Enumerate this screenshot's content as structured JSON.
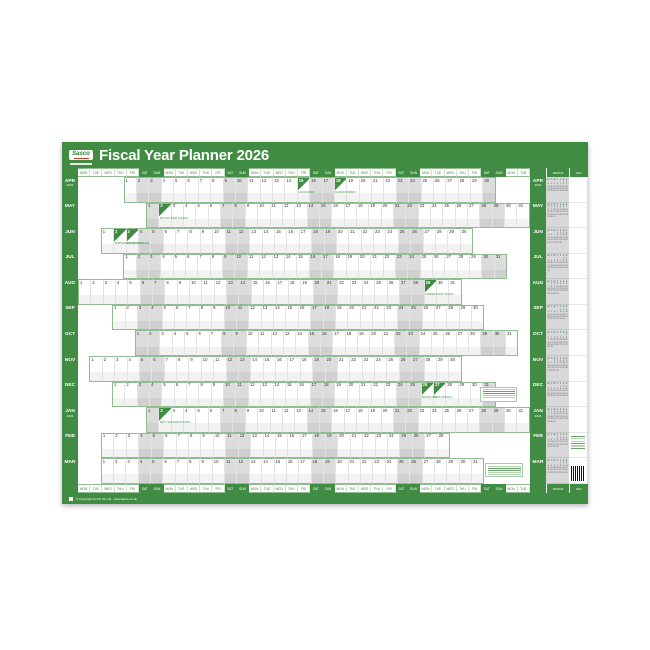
{
  "planner": {
    "brand": "Sasco",
    "title": "Fiscal Year Planner 2026",
    "side_header_year": "2023/24",
    "side_header_key": "KEY",
    "footer_text": "© Copyright ACCO UK Ltd · www.sasco.co.uk",
    "colors": {
      "green": "#3f8c42",
      "weekend_grey": "#dcdcdc",
      "logo_red": "#d23b2f"
    },
    "columns": 37,
    "day_names": [
      "MON",
      "TUE",
      "WED",
      "THU",
      "FRI",
      "SAT",
      "SUN"
    ],
    "months": [
      {
        "label": "APR",
        "year": "2022",
        "start_col": 5,
        "days": 30,
        "holidays": [
          {
            "day": 15,
            "name": "GOOD FRIDAY"
          },
          {
            "day": 18,
            "name": "EASTER MONDAY"
          }
        ]
      },
      {
        "label": "MAY",
        "year": "",
        "start_col": 7,
        "days": 31,
        "holidays": [
          {
            "day": 2,
            "name": "MAY DAY BANK HOLIDAY"
          }
        ]
      },
      {
        "label": "JUN",
        "year": "",
        "start_col": 3,
        "days": 30,
        "holidays": [
          {
            "day": 2,
            "name": "SPRING BANK HOLIDAY"
          },
          {
            "day": 3,
            "name": "PLATINUM JUBILEE"
          }
        ]
      },
      {
        "label": "JUL",
        "year": "",
        "start_col": 5,
        "days": 31,
        "holidays": []
      },
      {
        "label": "AUG",
        "year": "",
        "start_col": 1,
        "days": 31,
        "holidays": [
          {
            "day": 29,
            "name": "SUMMER BANK HOLIDAY"
          }
        ]
      },
      {
        "label": "SEP",
        "year": "",
        "start_col": 4,
        "days": 30,
        "holidays": []
      },
      {
        "label": "OCT",
        "year": "",
        "start_col": 6,
        "days": 31,
        "holidays": []
      },
      {
        "label": "NOV",
        "year": "",
        "start_col": 2,
        "days": 30,
        "holidays": []
      },
      {
        "label": "DEC",
        "year": "",
        "start_col": 4,
        "days": 31,
        "holidays": [
          {
            "day": 26,
            "name": "BOXING DAY"
          },
          {
            "day": 27,
            "name": "BANK HOLIDAY"
          }
        ]
      },
      {
        "label": "JAN",
        "year": "2023",
        "start_col": 7,
        "days": 31,
        "holidays": [
          {
            "day": 2,
            "name": "NEW YEAR BANK HOLIDAY"
          }
        ]
      },
      {
        "label": "FEB",
        "year": "",
        "start_col": 3,
        "days": 28,
        "holidays": []
      },
      {
        "label": "MAR",
        "year": "",
        "start_col": 3,
        "days": 31,
        "holidays": []
      }
    ],
    "mini_calendars": {
      "header": "2023/24",
      "months": [
        {
          "label": "APR",
          "year": 2023,
          "month": 4
        },
        {
          "label": "MAY",
          "year": 2023,
          "month": 5
        },
        {
          "label": "JUN",
          "year": 2023,
          "month": 6
        },
        {
          "label": "JUL",
          "year": 2023,
          "month": 7
        },
        {
          "label": "AUG",
          "year": 2023,
          "month": 8
        },
        {
          "label": "SEP",
          "year": 2023,
          "month": 9
        },
        {
          "label": "OCT",
          "year": 2023,
          "month": 10
        },
        {
          "label": "NOV",
          "year": 2023,
          "month": 11
        },
        {
          "label": "DEC",
          "year": 2023,
          "month": 12
        },
        {
          "label": "JAN",
          "year": 2024,
          "month": 1
        },
        {
          "label": "FEB",
          "year": 2024,
          "month": 2
        },
        {
          "label": "MAR",
          "year": 2024,
          "month": 3
        }
      ]
    }
  }
}
